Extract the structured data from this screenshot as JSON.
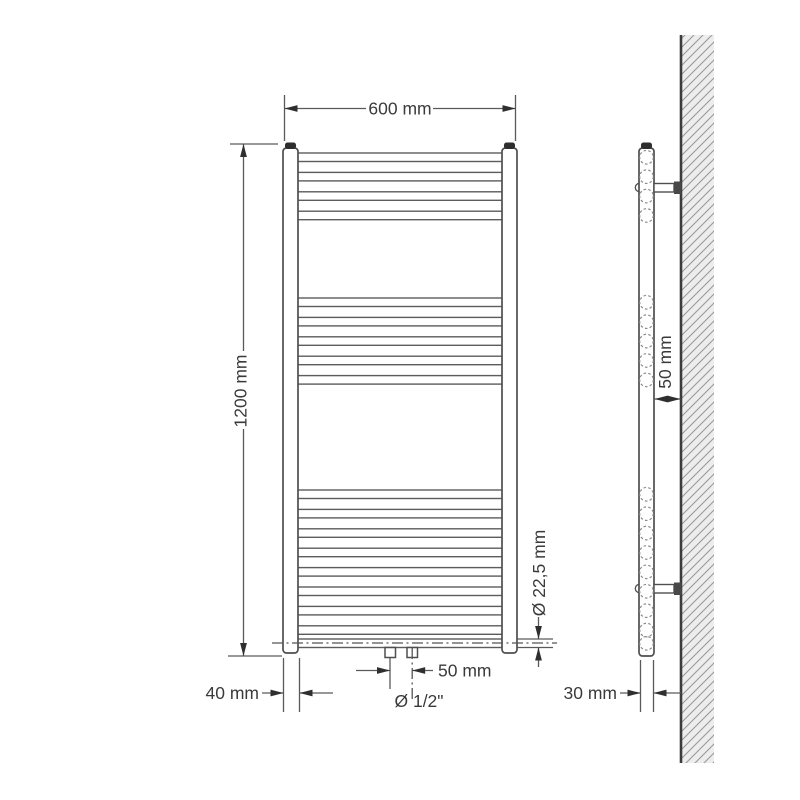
{
  "front_view": {
    "labels": {
      "width": "600 mm",
      "height": "1200 mm",
      "collector_width": "40 mm",
      "connection_spacing": "50 mm",
      "connection_size": "Ø 1/2\"",
      "rung_diameter": "Ø 22,5 mm"
    },
    "rung_groups": [
      4,
      5,
      9
    ]
  },
  "side_view": {
    "labels": {
      "wall_clearance": "50 mm",
      "depth": "30 mm"
    }
  },
  "colors": {
    "line": "#4f4f4f",
    "text": "#3a3a3a",
    "hatch_background": "#ededed",
    "hatch_line": "#9a9a9a",
    "cap_fill": "#2e2e2e"
  }
}
